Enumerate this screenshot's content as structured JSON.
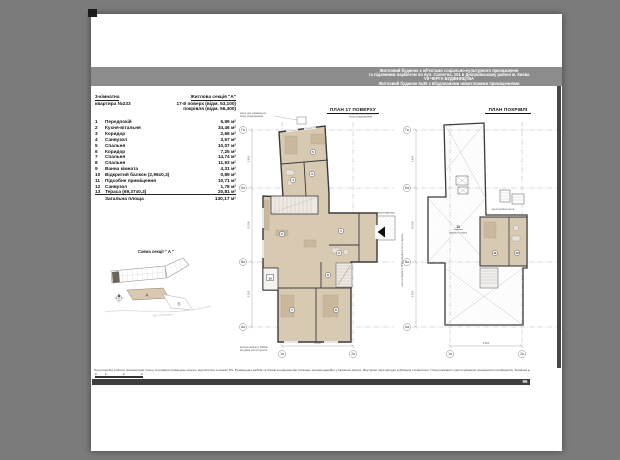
{
  "colors": {
    "background": "#7b7b7b",
    "paper": "#ffffff",
    "header_band": "#8c8c8c",
    "room_fill": "#d8c9b3",
    "furniture": "#c9b89e",
    "wall": "#3a3a3a",
    "footer_bar": "#3e3e3e"
  },
  "header": {
    "lines": [
      "Житловий будинок з об'єктами соціально-культурного призначення",
      "та підземним паркінгом по вул. Салютна, 101 в Дніпровському районі м. Києва",
      "VII ЧЕРГА БУДІВНИЦТВА",
      "Житловий будинок №35 з вбудованими нежитловими приміщеннями"
    ]
  },
  "info": {
    "rooms_count": "3-кімнатна",
    "apartment": "квартира №233",
    "section": "Житлова секція \"А\"",
    "floor": "17-й поверх (відм. 53,100)",
    "roof": "покрівля (відм. 56,400)"
  },
  "table": {
    "rows": [
      {
        "num": "1",
        "name": "Передпокій",
        "area": "6,99 м²"
      },
      {
        "num": "2",
        "name": "Кухня-вітальня",
        "area": "34,46 м²"
      },
      {
        "num": "3",
        "name": "Коридор",
        "area": "2,66 м²"
      },
      {
        "num": "4",
        "name": "Санвузол",
        "area": "3,57 м²"
      },
      {
        "num": "5",
        "name": "Спальня",
        "area": "10,07 м²"
      },
      {
        "num": "6",
        "name": "Коридор",
        "area": "7,25 м²"
      },
      {
        "num": "7",
        "name": "Спальня",
        "area": "14,74 м²"
      },
      {
        "num": "8",
        "name": "Спальня",
        "area": "11,93 м²"
      },
      {
        "num": "9",
        "name": "Ванна кімната",
        "area": "4,31 м²"
      },
      {
        "num": "10",
        "name": "Відкритий балкон (2,96х0,3)",
        "area": "0,89 м²"
      },
      {
        "num": "11",
        "name": "Підсобне приміщення",
        "area": "10,71 м²"
      },
      {
        "num": "12",
        "name": "Санвузол",
        "area": "1,78 м²"
      },
      {
        "num": "13",
        "name": "Тераса (69,37х0,3)",
        "area": "20,81 м²"
      }
    ],
    "total_label": "Загальна площа",
    "total_value": "130,17 м²"
  },
  "schema": {
    "title": "Схема секції \" А \"",
    "label_a": "А",
    "label_b": "Б",
    "street": "вул. Салютна"
  },
  "plans": {
    "floor": {
      "title": "ПЛАН 17 ПОВЕРХУ",
      "axis_left": [
        "Га",
        "Ба",
        "Ва",
        "Аа"
      ],
      "axis_bottom": [
        "1а",
        "2а"
      ],
      "badges": [
        "1",
        "2",
        "3",
        "4",
        "5",
        "6",
        "7",
        "8",
        "9",
        "10"
      ],
      "note_ac_l1": "місце для зовнішнього",
      "note_ac_l2": "блоку кондиціонера",
      "note_parapet_l1": "висота парапету 300мм",
      "note_parapet_l2": "від рівня чистої підлоги",
      "entry_label": "вхід в квартиру",
      "dims": {
        "left": [
          "1.400",
          "10.500",
          "5.300"
        ],
        "bottom": "8.500"
      }
    },
    "roof": {
      "title": "ПЛАН ПОКРІВЛІ",
      "axis_left": [
        "Га",
        "Ба",
        "Ва",
        "Аа"
      ],
      "axis_bottom": [
        "1а",
        "2а"
      ],
      "badges": [
        "11",
        "12",
        "13"
      ],
      "vent_label": "вентиляційна шахта",
      "terrace_note": "покриття тераси",
      "note_parapet": "висота парапету 300мм від рівня чистої підлоги",
      "dims": {
        "left": [
          "1.400",
          "10.500",
          "5.300"
        ],
        "bottom": "9.400"
      }
    }
  },
  "footer": {
    "note": "При розробці робочої документації площі та розміри приміщень можуть відхилятись в межах 5%. Розміщення меблів та блоків кондиціонерів показано рекомендаційно у вказаних місцях. Внутрішні перегородки зображені схематично. Площі вказані із застосуванням понижуючих коефіцієнтів. Зовнішні конструкції зображені умовно. ПЖ ______",
    "sheet_ref": "Креслення 1-А",
    "scale": [
      "0",
      "1",
      "2",
      "3"
    ],
    "page_number": "96"
  }
}
